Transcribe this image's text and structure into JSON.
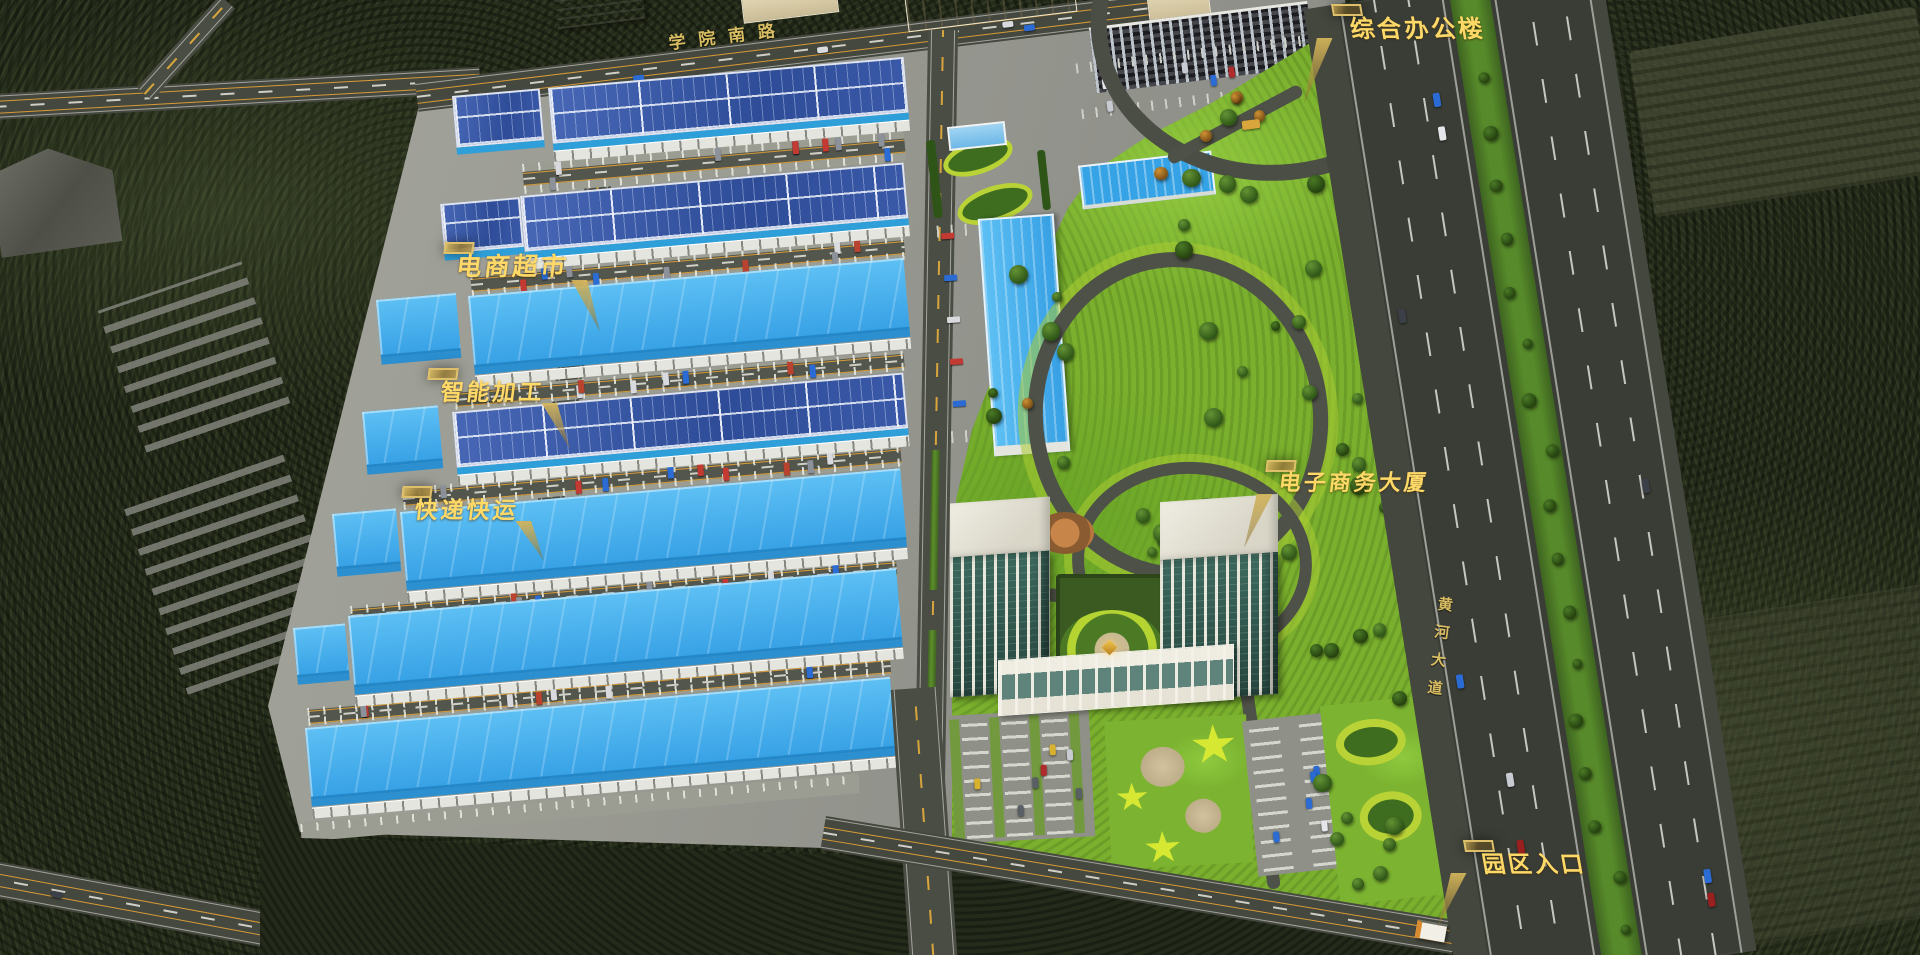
{
  "callouts": {
    "office_building": {
      "label": "综合办公楼"
    },
    "ecommerce_supermarket": {
      "label": "电商超市"
    },
    "smart_processing": {
      "label": "智能加工"
    },
    "express_delivery": {
      "label": "快递快运"
    },
    "ecommerce_tower": {
      "label": "电子商务大厦"
    },
    "park_entrance": {
      "label": "园区入口"
    }
  },
  "road_names": {
    "north_road": "学院南路",
    "east_avenue": "黄河大道"
  },
  "colors": {
    "label_text_gold": "#ffd968",
    "label_border_gold": "#dfc06a",
    "road_name_gold": "#d9bd62",
    "cyan_roof": "#45b0ec",
    "solar_panel_blue": "#31519e",
    "lawn_green": "#7ab02d",
    "asphalt": "#45483f"
  }
}
